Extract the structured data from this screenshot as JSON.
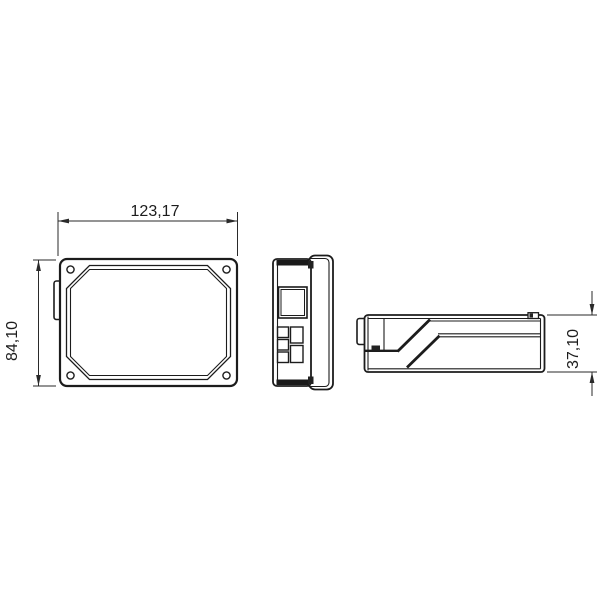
{
  "drawing": {
    "background_color": "#ffffff",
    "line_color": "#1c1c1c",
    "dark_fill_color": "#1a1a1a",
    "dimensions": {
      "width_label": "123,17",
      "height_label": "84,10",
      "depth_label": "37,10"
    }
  }
}
